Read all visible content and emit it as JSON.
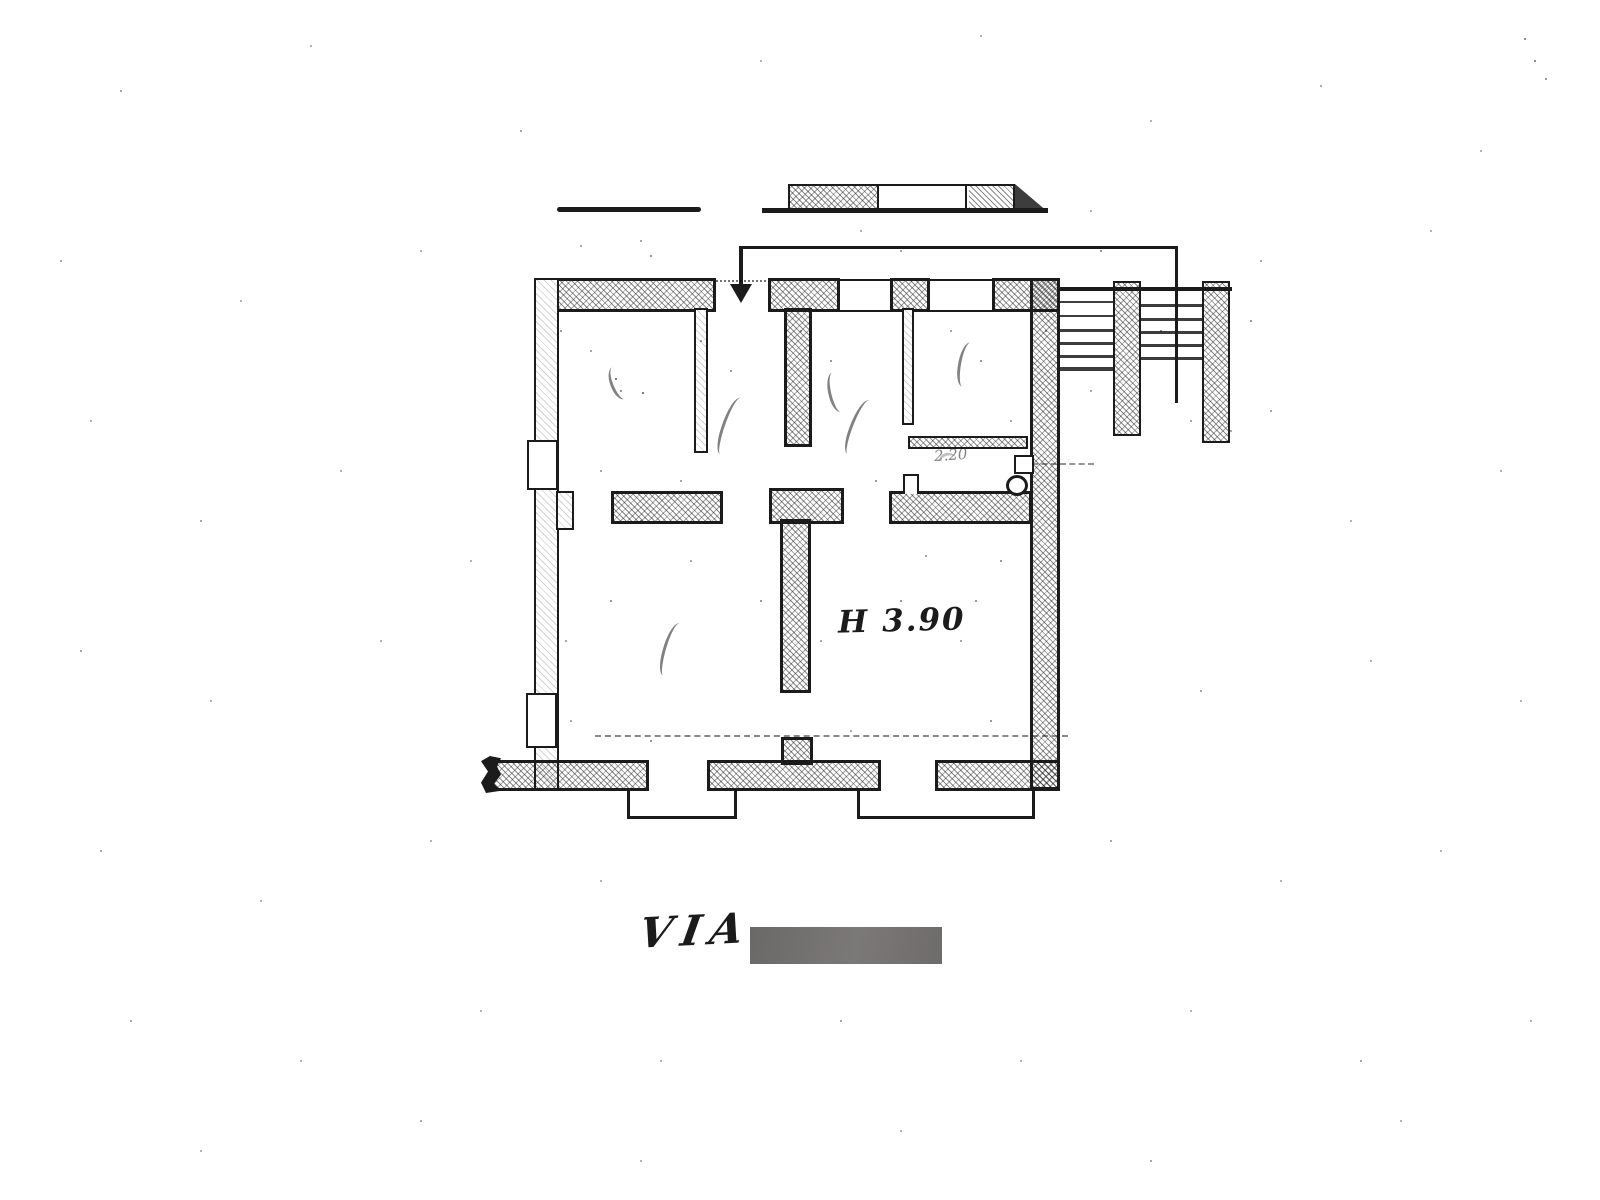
{
  "document_kind": "scanned floor plan",
  "colors": {
    "ink": "#1b1b1b",
    "paper": "#ffffff",
    "redaction": "#6f6c6c"
  },
  "annotations": {
    "ceiling_height": "H 3.90",
    "bath_dimension": "2.20",
    "street_label": "VIA"
  }
}
